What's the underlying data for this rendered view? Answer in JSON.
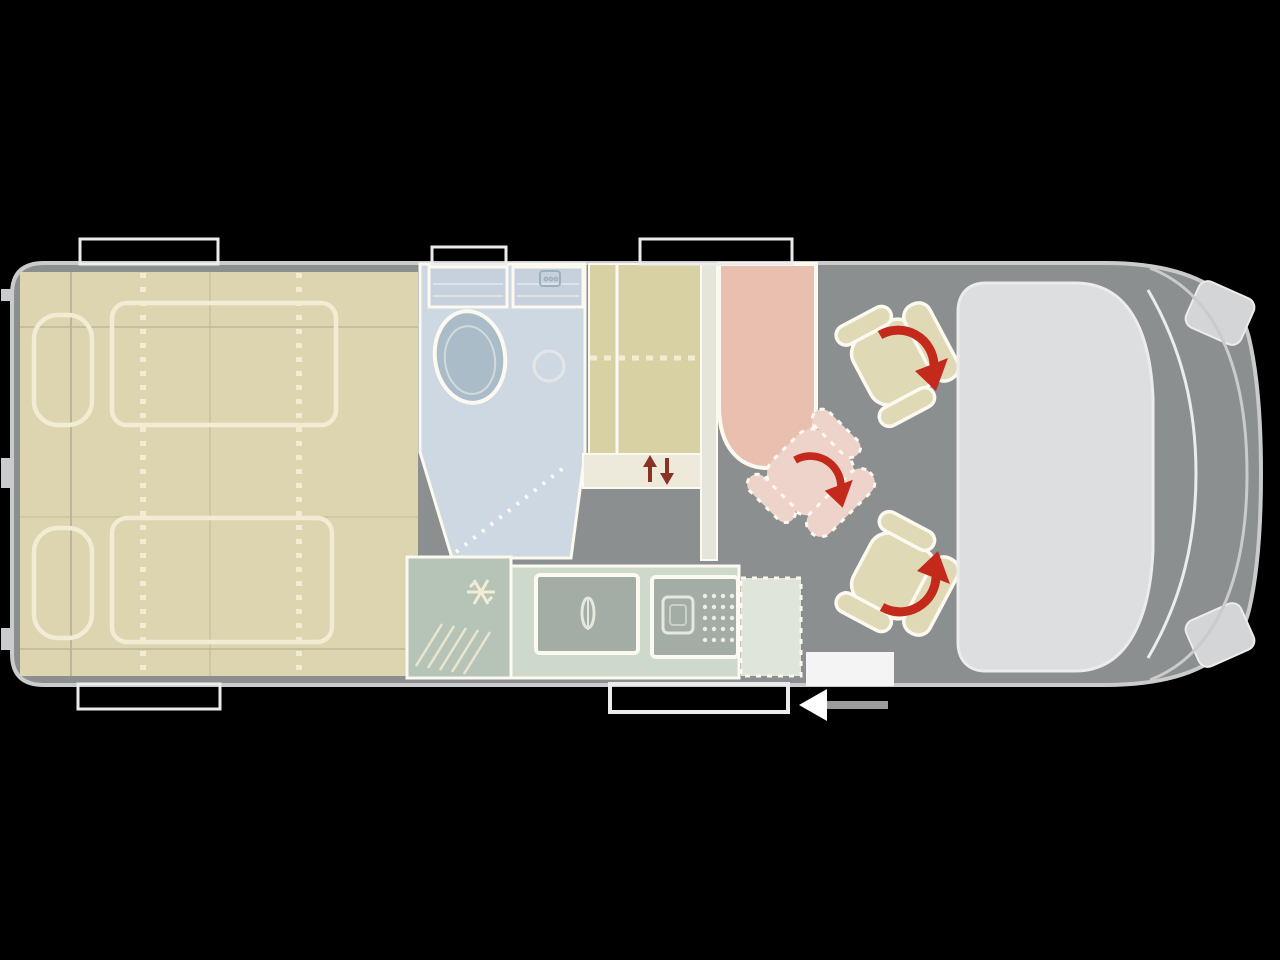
{
  "diagram": {
    "type": "campervan-floorplan-top-view",
    "vehicle_front": "right",
    "regions": [
      {
        "name": "rear-bed-area",
        "furniture": [
          "pillow-left-top",
          "pillow-left-bottom",
          "bed-outline-top",
          "bed-outline-bottom",
          "fold-lines"
        ]
      },
      {
        "name": "bathroom",
        "furniture": [
          "shelf-left",
          "shelf-right",
          "toilet",
          "shower-drain",
          "shower-door-dashed-line"
        ]
      },
      {
        "name": "wardrobe",
        "furniture": [
          "divider",
          "dashed-shelf-line",
          "step-strip-with-up-down-arrows"
        ]
      },
      {
        "name": "kitchen",
        "furniture": [
          "fridge-with-snowflake",
          "counter",
          "sink-with-faucet",
          "stove-with-burner-and-grid",
          "dashed-pad"
        ]
      },
      {
        "name": "lounge",
        "furniture": [
          "dinette-bench",
          "swivel-seat-front",
          "swivel-seat-rear",
          "seat-ghost-rotated",
          "rotation-arrows"
        ]
      },
      {
        "name": "cab",
        "furniture": [
          "dashboard",
          "windshield",
          "front-bumper",
          "corner-light-top",
          "corner-light-bottom"
        ]
      },
      {
        "name": "openings",
        "furniture": [
          "window-marker-top-left",
          "window-marker-top-middle",
          "window-marker-top-right",
          "window-marker-bottom-left",
          "entry-door-marker",
          "entry-step",
          "direction-arrow"
        ]
      }
    ],
    "icons": {
      "snowflake-icon": "fridge / refrigerator",
      "faucet-icon": "kitchen sink tap",
      "burner-icon": "stove burner",
      "rotation-arrow-icon": "seat swivels (red curved arrow)",
      "up-down-arrow-icon": "height adjustment (red up/down arrows)",
      "direction-arrow-icon": "entry arrow pointing left",
      "shower-drain-icon": "shower drain circle",
      "shower-head-icon": "small bathroom fitting glyph"
    },
    "colors": {
      "background": "#000000",
      "floor": "#8c8f90",
      "body_outline": "#c9cbcc",
      "furniture_outline": "#fcf9f0",
      "bed": "#ddd4b0",
      "bed_trim": "#f2ecd4",
      "bed_line": "#bdb59a",
      "wardrobe": "#d7d1a4",
      "wardrobe_step": "#edeadc",
      "side_column": "#e5e6d9",
      "bathroom": "#cdd8e2",
      "toilet": "#a9bcc8",
      "shelf": "#c6d1dd",
      "bath_detail": "#9fb0bd",
      "kitchen_counter": "#cfd9cb",
      "fridge": "#b6c4b7",
      "appliance": "#a4aca6",
      "appliance_detail": "#e4e8de",
      "table_pad": "#dfe5d8",
      "bench": "#e9c0af",
      "seat": "#e0d9b6",
      "seat_ghost": "#eed3ca",
      "cab_dashboard": "#dcdedf",
      "cab_trim": "#d3d5d6",
      "windshield_line": "#ececec",
      "rotation_arrow": "#c32a1c",
      "updown_arrow": "#8a3223",
      "step": "#f4f4f4",
      "direction_arrow": "#ffffff",
      "direction_tail": "#9b9b9b"
    }
  }
}
